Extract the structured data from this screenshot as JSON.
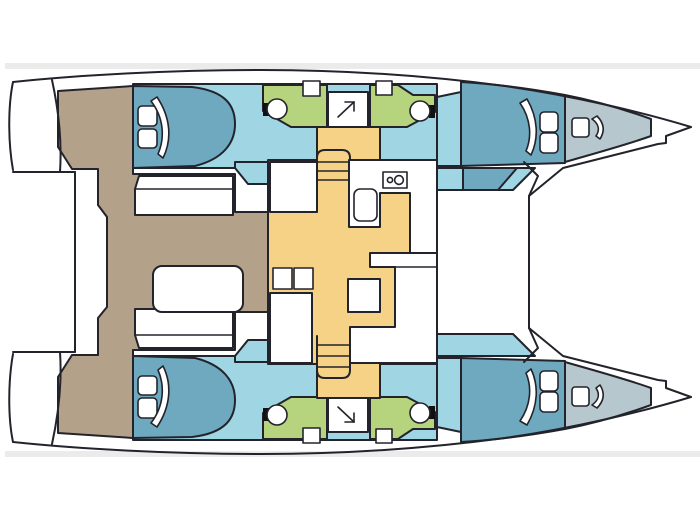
{
  "diagram": {
    "type": "boat-floor-plan",
    "subject": "catamaran sailing yacht interior layout, top-down deck plan",
    "orientation": "bow pointing right, stern at left, port hull at top, starboard hull at bottom",
    "visible_text": "none"
  },
  "colors": {
    "background": "#ffffff",
    "photo_edge_stripe": "#ebebeb",
    "outline": "#23232b",
    "cockpit_deck_tan": "#b3a189",
    "hull_interior_light_blue": "#a0d5e4",
    "bed_medium_blue": "#6fa9bf",
    "forepeak_gray_blue": "#b7c7ce",
    "head_green": "#b6d37d",
    "saloon_floor_orange": "#f6d287",
    "furniture_white": "#ffffff",
    "fixture_black": "#111111"
  },
  "vessel": {
    "hulls": 2,
    "double_cabins": 4,
    "head_compartments": 4,
    "shower_stalls": 2,
    "port_hull_top": {
      "aft_cabin": [
        "double-bed",
        "two-pillows",
        "door-swing"
      ],
      "aft_head": [
        "toilet",
        "wash-basin"
      ],
      "shower": [
        "arrow-symbol-up-right"
      ],
      "forward_head": [
        "toilet",
        "wash-basin"
      ],
      "forward_cabin": [
        "double-bed",
        "two-pillows",
        "door-swing"
      ],
      "forepeak": [
        "deck-hatch",
        "door-swing"
      ]
    },
    "starboard_hull_bottom": {
      "aft_cabin": [
        "double-bed",
        "two-pillows",
        "door-swing"
      ],
      "aft_head": [
        "toilet",
        "wash-basin"
      ],
      "shower": [
        "arrow-symbol-down-right"
      ],
      "forward_head": [
        "toilet",
        "wash-basin"
      ],
      "forward_cabin": [
        "double-bed",
        "two-pillows",
        "door-swing"
      ],
      "forepeak": [
        "deck-hatch",
        "door-swing"
      ]
    },
    "saloon": {
      "galley": [
        "two-burner-stove",
        "sink",
        "l-shaped-counter"
      ],
      "furniture": [
        "dining-table",
        "l-shaped-settee",
        "cabinet",
        "storage-block",
        "two-lockers"
      ],
      "stairs": [
        "companionway-to-port-hull",
        "companionway-to-starboard-hull"
      ]
    },
    "cockpit": {
      "furniture": [
        "aft-bench",
        "forward-bench",
        "cockpit-table"
      ],
      "access": [
        "port-transom-steps",
        "starboard-transom-steps",
        "aft-platform"
      ]
    },
    "foredeck": [
      "trampoline-area",
      "crossbeam-lines"
    ]
  }
}
